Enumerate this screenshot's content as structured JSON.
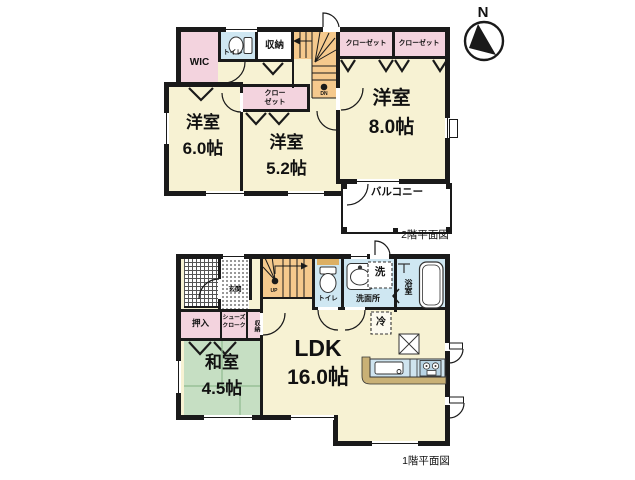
{
  "titles": {
    "floor2": "2階平面図",
    "floor1": "1階平面図",
    "compass_n": "N"
  },
  "floor2": {
    "wic": "WIC",
    "toilet": "トイレ",
    "storage": "収納",
    "closet_a": "クローゼット",
    "closet_b": "クローゼット",
    "closet_small_line1": "クロー",
    "closet_small_line2": "ゼット",
    "room6_name": "洋室",
    "room6_size": "6.0帖",
    "room52_name": "洋室",
    "room52_size": "5.2帖",
    "room8_name": "洋室",
    "room8_size": "8.0帖",
    "balcony": "バルコニー",
    "stairs_dn": "DN"
  },
  "floor1": {
    "genkan": "玄関",
    "oshiire": "押入",
    "shoes_line1": "シューズ",
    "shoes_line2": "クローク",
    "storage": "収納",
    "stairs_up": "UP",
    "toilet": "トイレ",
    "washroom": "洗面所",
    "washer": "洗",
    "bath": "浴室",
    "fridge": "冷",
    "washitsu_name": "和室",
    "washitsu_size": "4.5帖",
    "ldk_name": "LDK",
    "ldk_size": "16.0帖"
  },
  "colors": {
    "wall": "#1a1a1a",
    "room_cream": "#f7f2d3",
    "closet_pink": "#f3d3de",
    "water_blue": "#cfe7f2",
    "stairs_orange": "#f5c98d",
    "tatami_green": "#c6dfc3",
    "kitchen_counter_tan": "#c9b176",
    "shelf_tan": "#dcaf63"
  }
}
